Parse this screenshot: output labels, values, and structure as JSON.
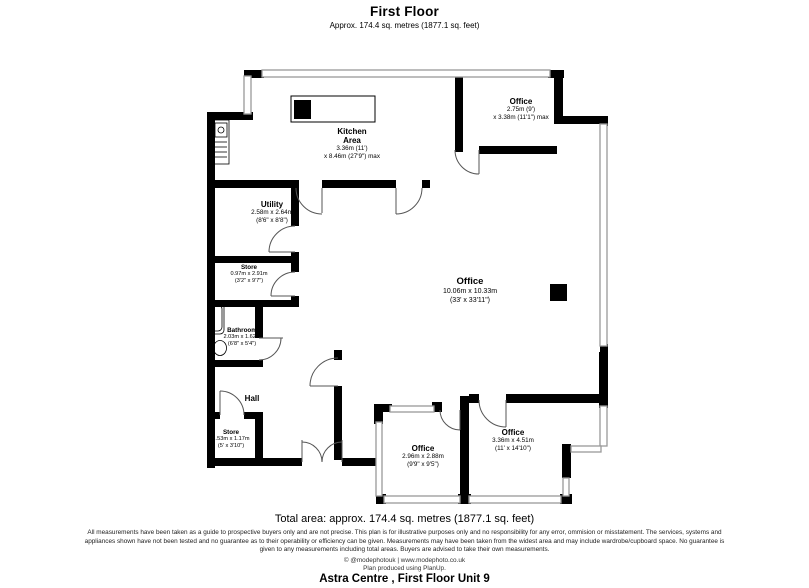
{
  "header": {
    "title": "First Floor",
    "subtitle": "Approx. 174.4 sq. metres (1877.1 sq. feet)"
  },
  "rooms": {
    "kitchen": {
      "name": "Kitchen",
      "name2": "Area",
      "dim1": "3.36m (11')",
      "dim2": "x 8.46m (27'9\") max"
    },
    "office_top_right": {
      "name": "Office",
      "dim1": "2.75m (9')",
      "dim2": "x 3.38m (11'1\") max"
    },
    "utility": {
      "name": "Utility",
      "dim1": "2.58m x 2.64m",
      "dim2": "(8'6\" x 8'8\")"
    },
    "store_upper": {
      "name": "Store",
      "dim1": "0.97m x 2.91m",
      "dim2": "(3'2\" x 9'7\")"
    },
    "bathroom": {
      "name": "Bathroom",
      "dim1": "2.03m x 1.62m",
      "dim2": "(6'8\" x 5'4\")"
    },
    "hall": {
      "name": "Hall"
    },
    "store_lower": {
      "name": "Store",
      "dim1": "1.53m x 1.17m",
      "dim2": "(5' x 3'10\")"
    },
    "office_main": {
      "name": "Office",
      "dim1": "10.06m x 10.33m",
      "dim2": "(33' x 33'11\")"
    },
    "office_bottom_middle": {
      "name": "Office",
      "dim1": "2.96m x 2.88m",
      "dim2": "(9'9\" x 9'5\")"
    },
    "office_bottom_right": {
      "name": "Office",
      "dim1": "3.36m x 4.51m",
      "dim2": "(11' x 14'10\")"
    }
  },
  "footer": {
    "total_area": "Total area: approx. 174.4 sq. metres (1877.1 sq. feet)",
    "disclaimer": "All measurements have been taken as a guide to prospective buyers only and are not precise. This plan is for illustrative purposes only and no responsibility for any error, ommision or misstatement. The services, systems and appliances shown have not been tested and no guarantee as to their operability or efficiency can be given. Measurements may have been taken from the widest area and may include wardrobe/cupboard space. No guarantee is given to any measurements including total areas. Buyers are advised to take their own measurements.",
    "credit_line1": "© @modephotouk | www.modephoto.co.uk",
    "credit_line2": "Plan produced using PlanUp.",
    "property_title": "Astra Centre , First Floor Unit 9"
  },
  "colors": {
    "wall": "#000000",
    "window_stroke": "#999999",
    "door_stroke": "#555555"
  }
}
